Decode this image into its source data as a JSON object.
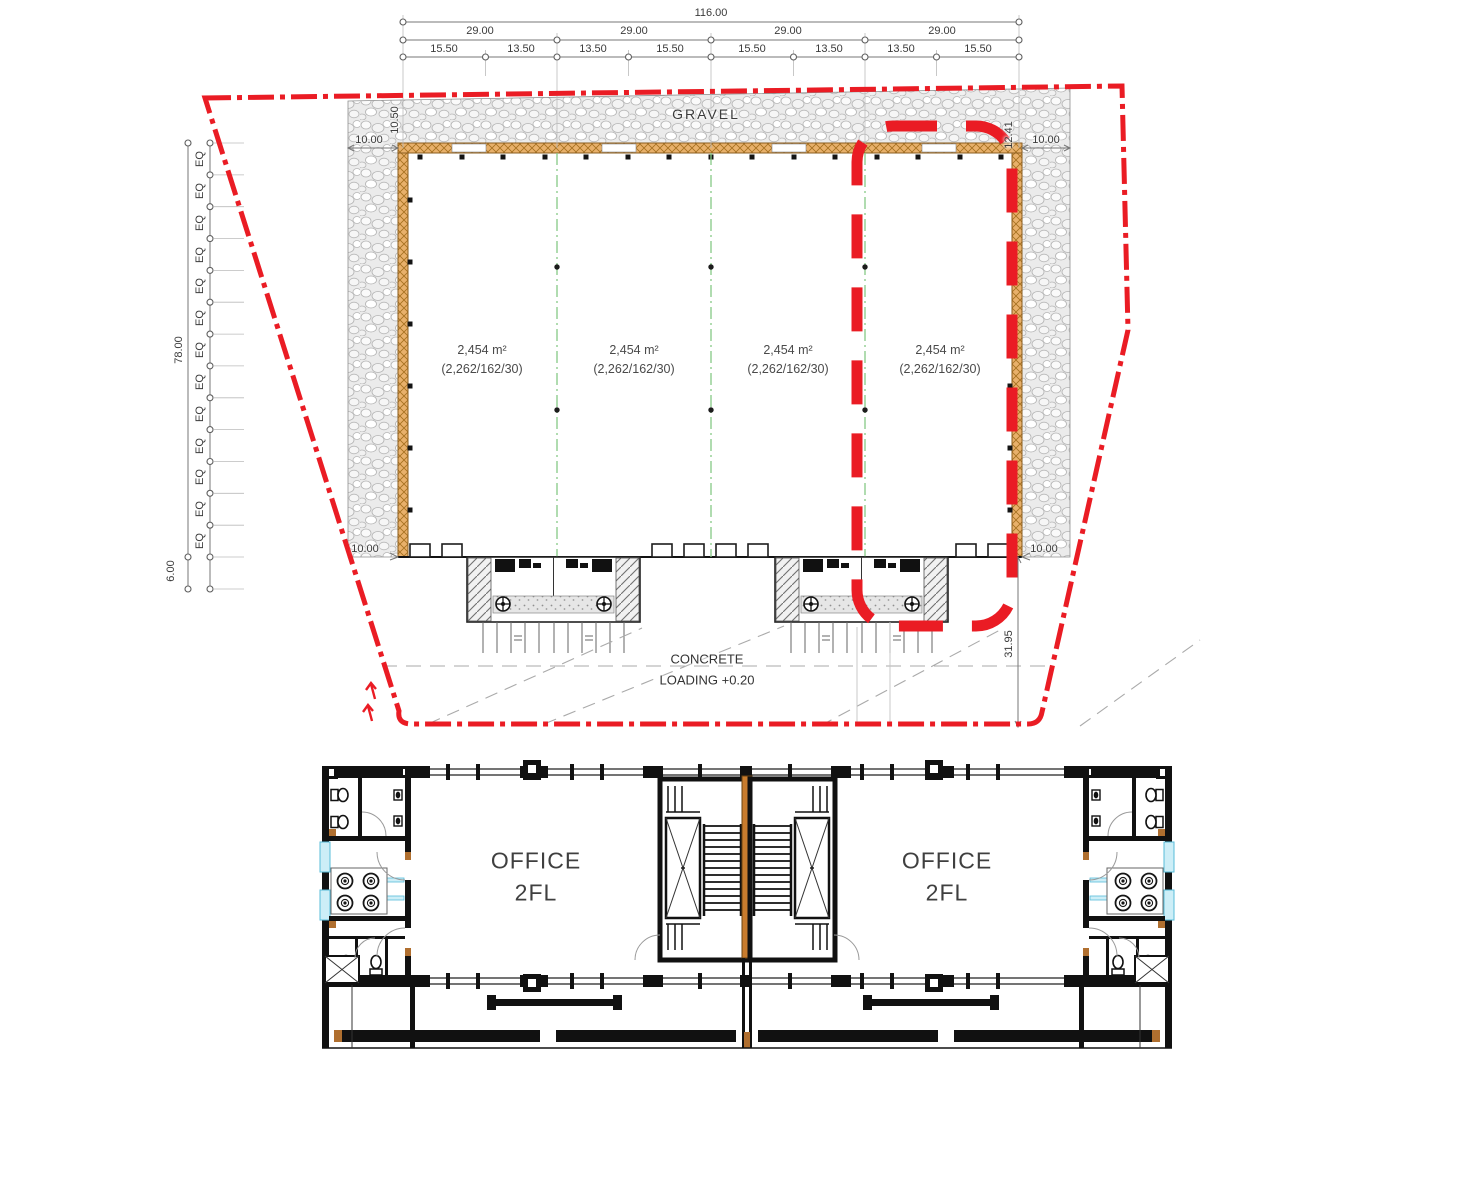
{
  "site": {
    "gravel_label": "GRAVEL",
    "concrete_label_1": "CONCRETE",
    "concrete_label_2": "LOADING +0.20",
    "dims": {
      "total": "116.00",
      "bay": "29.00",
      "subs": [
        "15.50",
        "13.50",
        "13.50",
        "15.50",
        "15.50",
        "13.50",
        "13.50",
        "15.50"
      ],
      "left_height": "78.00",
      "left_offset": "6.00",
      "eq": "EQ",
      "gravel_left": "10.50",
      "gravel_right": "12.41",
      "top_left": "10.00",
      "top_right": "10.00",
      "bottom_left": "10.00",
      "bottom_right": "10.00",
      "yard": "31.95"
    },
    "units": [
      {
        "area": "2,454 m²",
        "breakdown": "(2,262/162/30)"
      },
      {
        "area": "2,454 m²",
        "breakdown": "(2,262/162/30)"
      },
      {
        "area": "2,454 m²",
        "breakdown": "(2,262/162/30)"
      },
      {
        "area": "2,454 m²",
        "breakdown": "(2,262/162/30)"
      }
    ]
  },
  "floor": {
    "left": {
      "name": "OFFICE",
      "level": "2FL"
    },
    "right": {
      "name": "OFFICE",
      "level": "2FL"
    }
  },
  "colors": {
    "boundary_red": "#ea1c24",
    "wall_orange": "#e8b06a",
    "party_wall_orange": "#c87c2e",
    "divider_green": "#86c986",
    "window_cyan": "#58bcd9"
  }
}
